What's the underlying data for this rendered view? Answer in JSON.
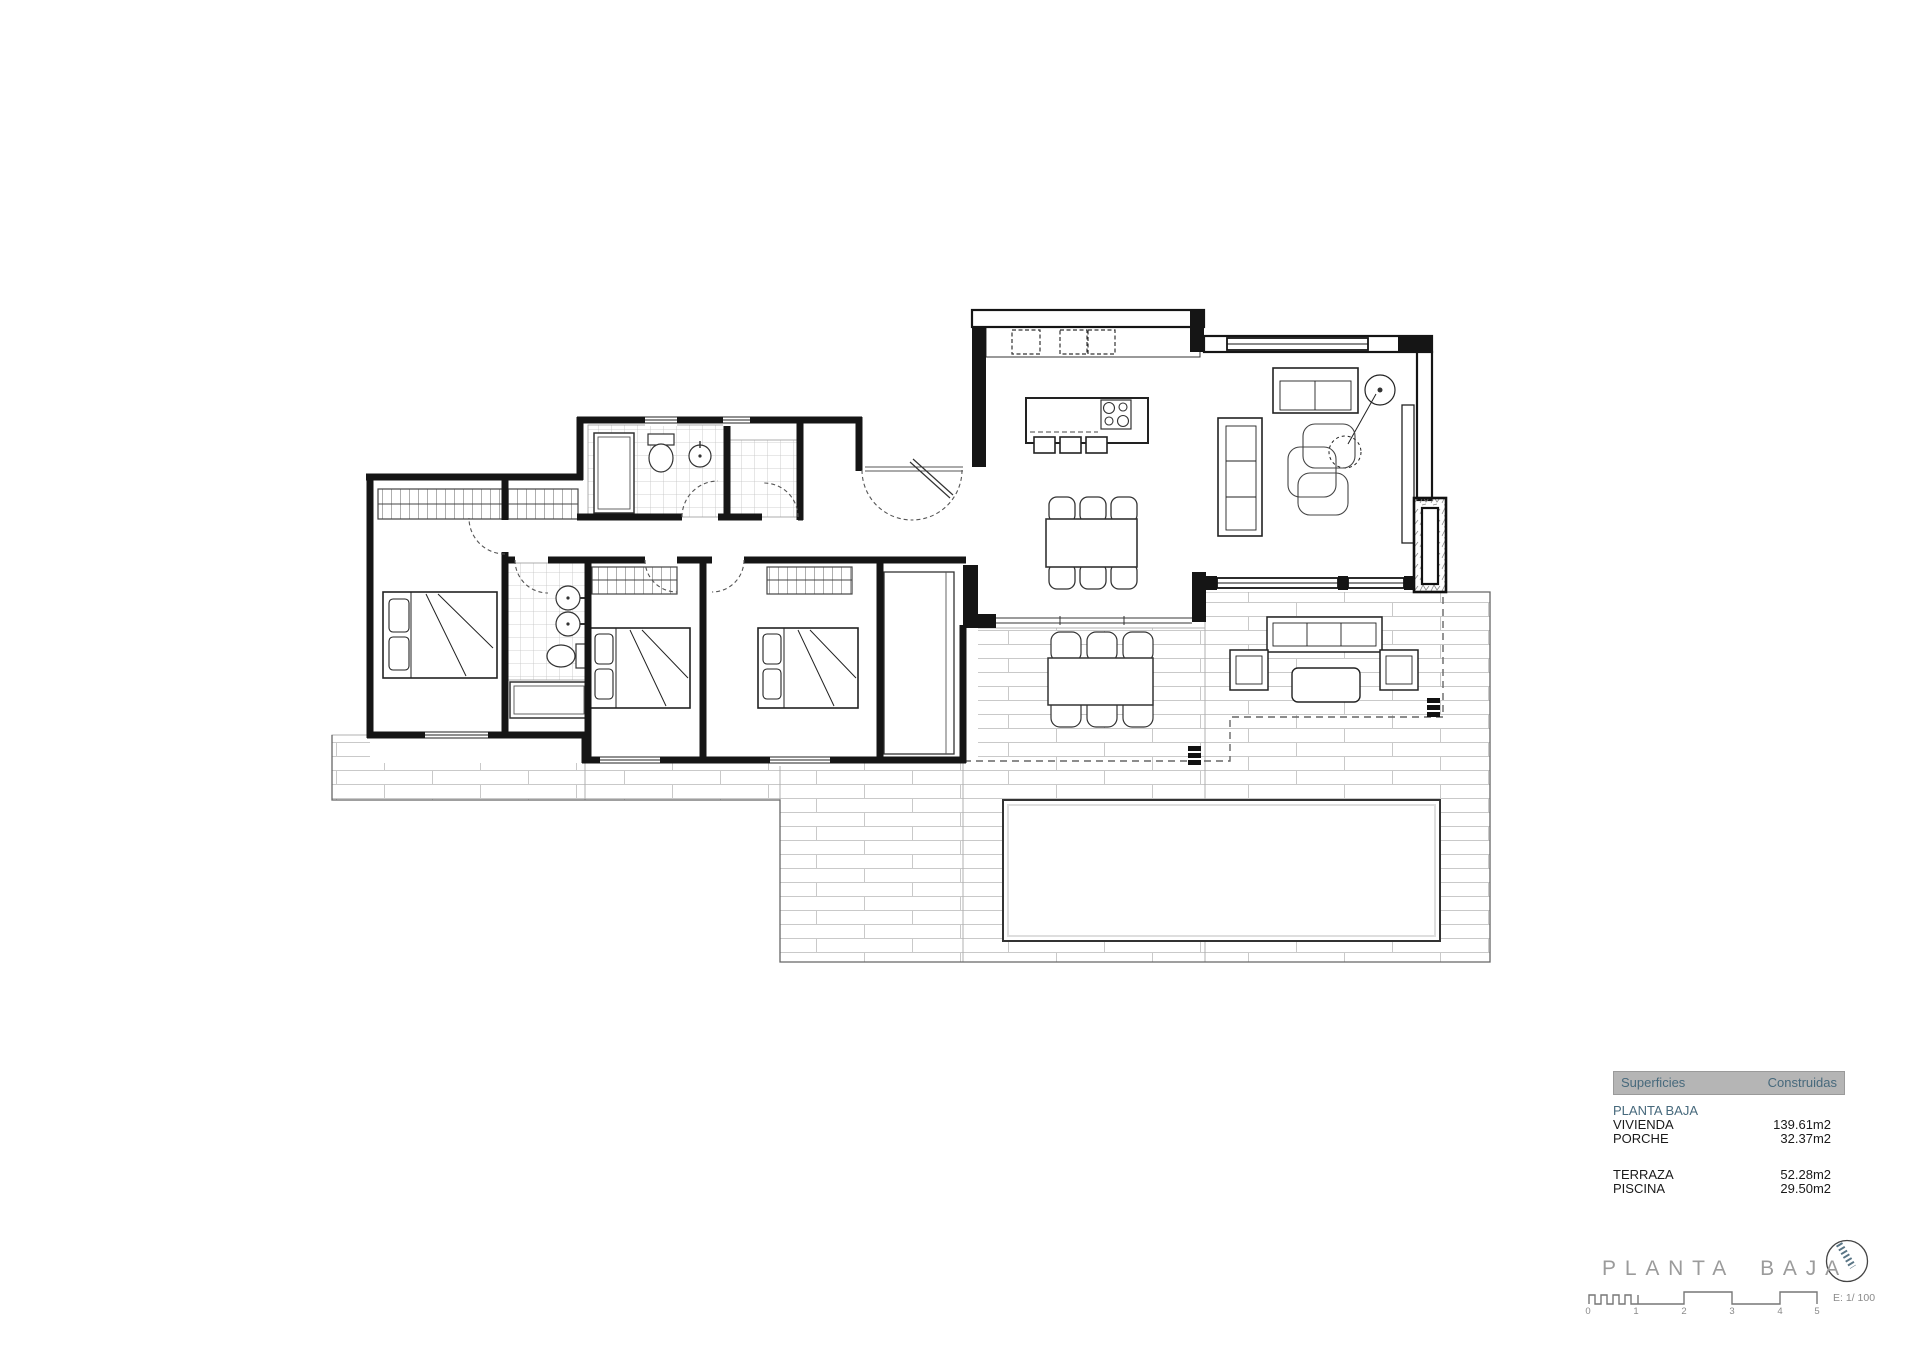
{
  "title": "PLANTA BAJA",
  "summary_table": {
    "header": {
      "col1": "Superficies",
      "col2": "Construidas"
    },
    "section": "PLANTA BAJA",
    "rows": [
      {
        "label": "VIVIENDA",
        "value": "139.61m2"
      },
      {
        "label": "PORCHE",
        "value": "32.37m2"
      },
      {
        "label": "TERRAZA",
        "value": "52.28m2"
      },
      {
        "label": "PISCINA",
        "value": "29.50m2"
      }
    ]
  },
  "scalebar": {
    "label": "E: 1/ 100",
    "ticks": [
      "0",
      "1",
      "2",
      "3",
      "4",
      "5"
    ]
  },
  "icons": {
    "north_arrow": "north-arrow-icon"
  },
  "colors": {
    "accent_bluegray": "#47697c",
    "table_header_bg": "#b5b5b5",
    "title_gray": "#9b9b9b",
    "wall_black": "#151515",
    "tile_line": "#c9c9c9"
  }
}
